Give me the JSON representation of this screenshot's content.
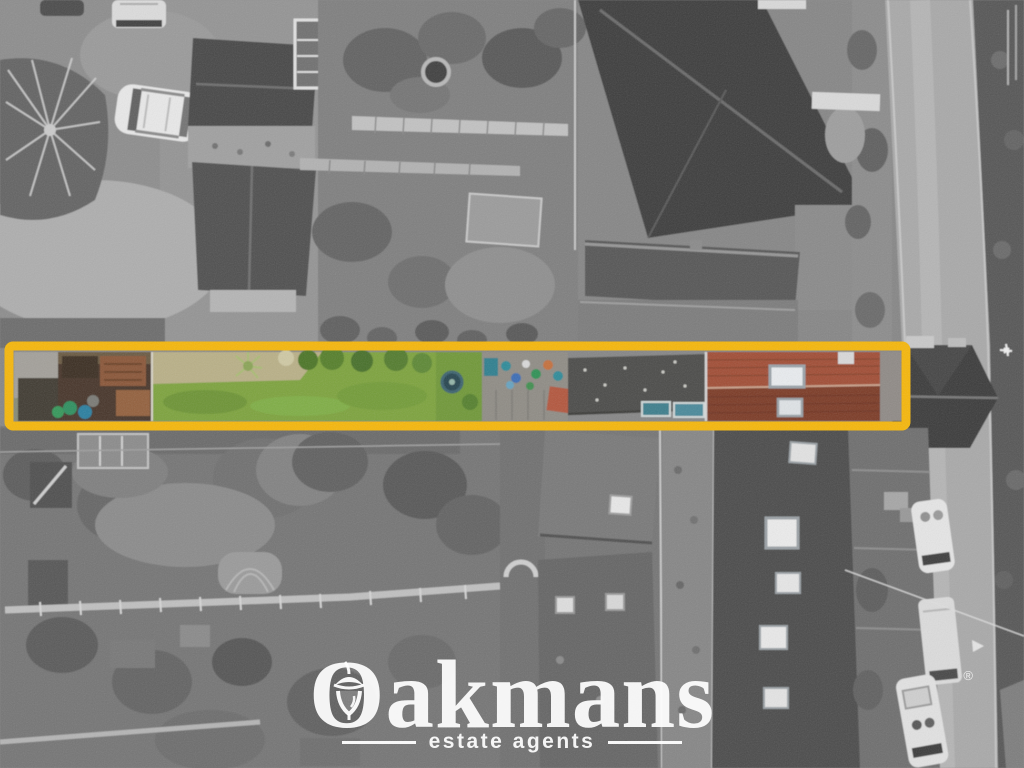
{
  "watermark": {
    "brand": "Oakmans",
    "tagline": "estate agents",
    "reg_mark": "®",
    "color": "#ffffff"
  },
  "highlight": {
    "color": "#f6b70a"
  }
}
